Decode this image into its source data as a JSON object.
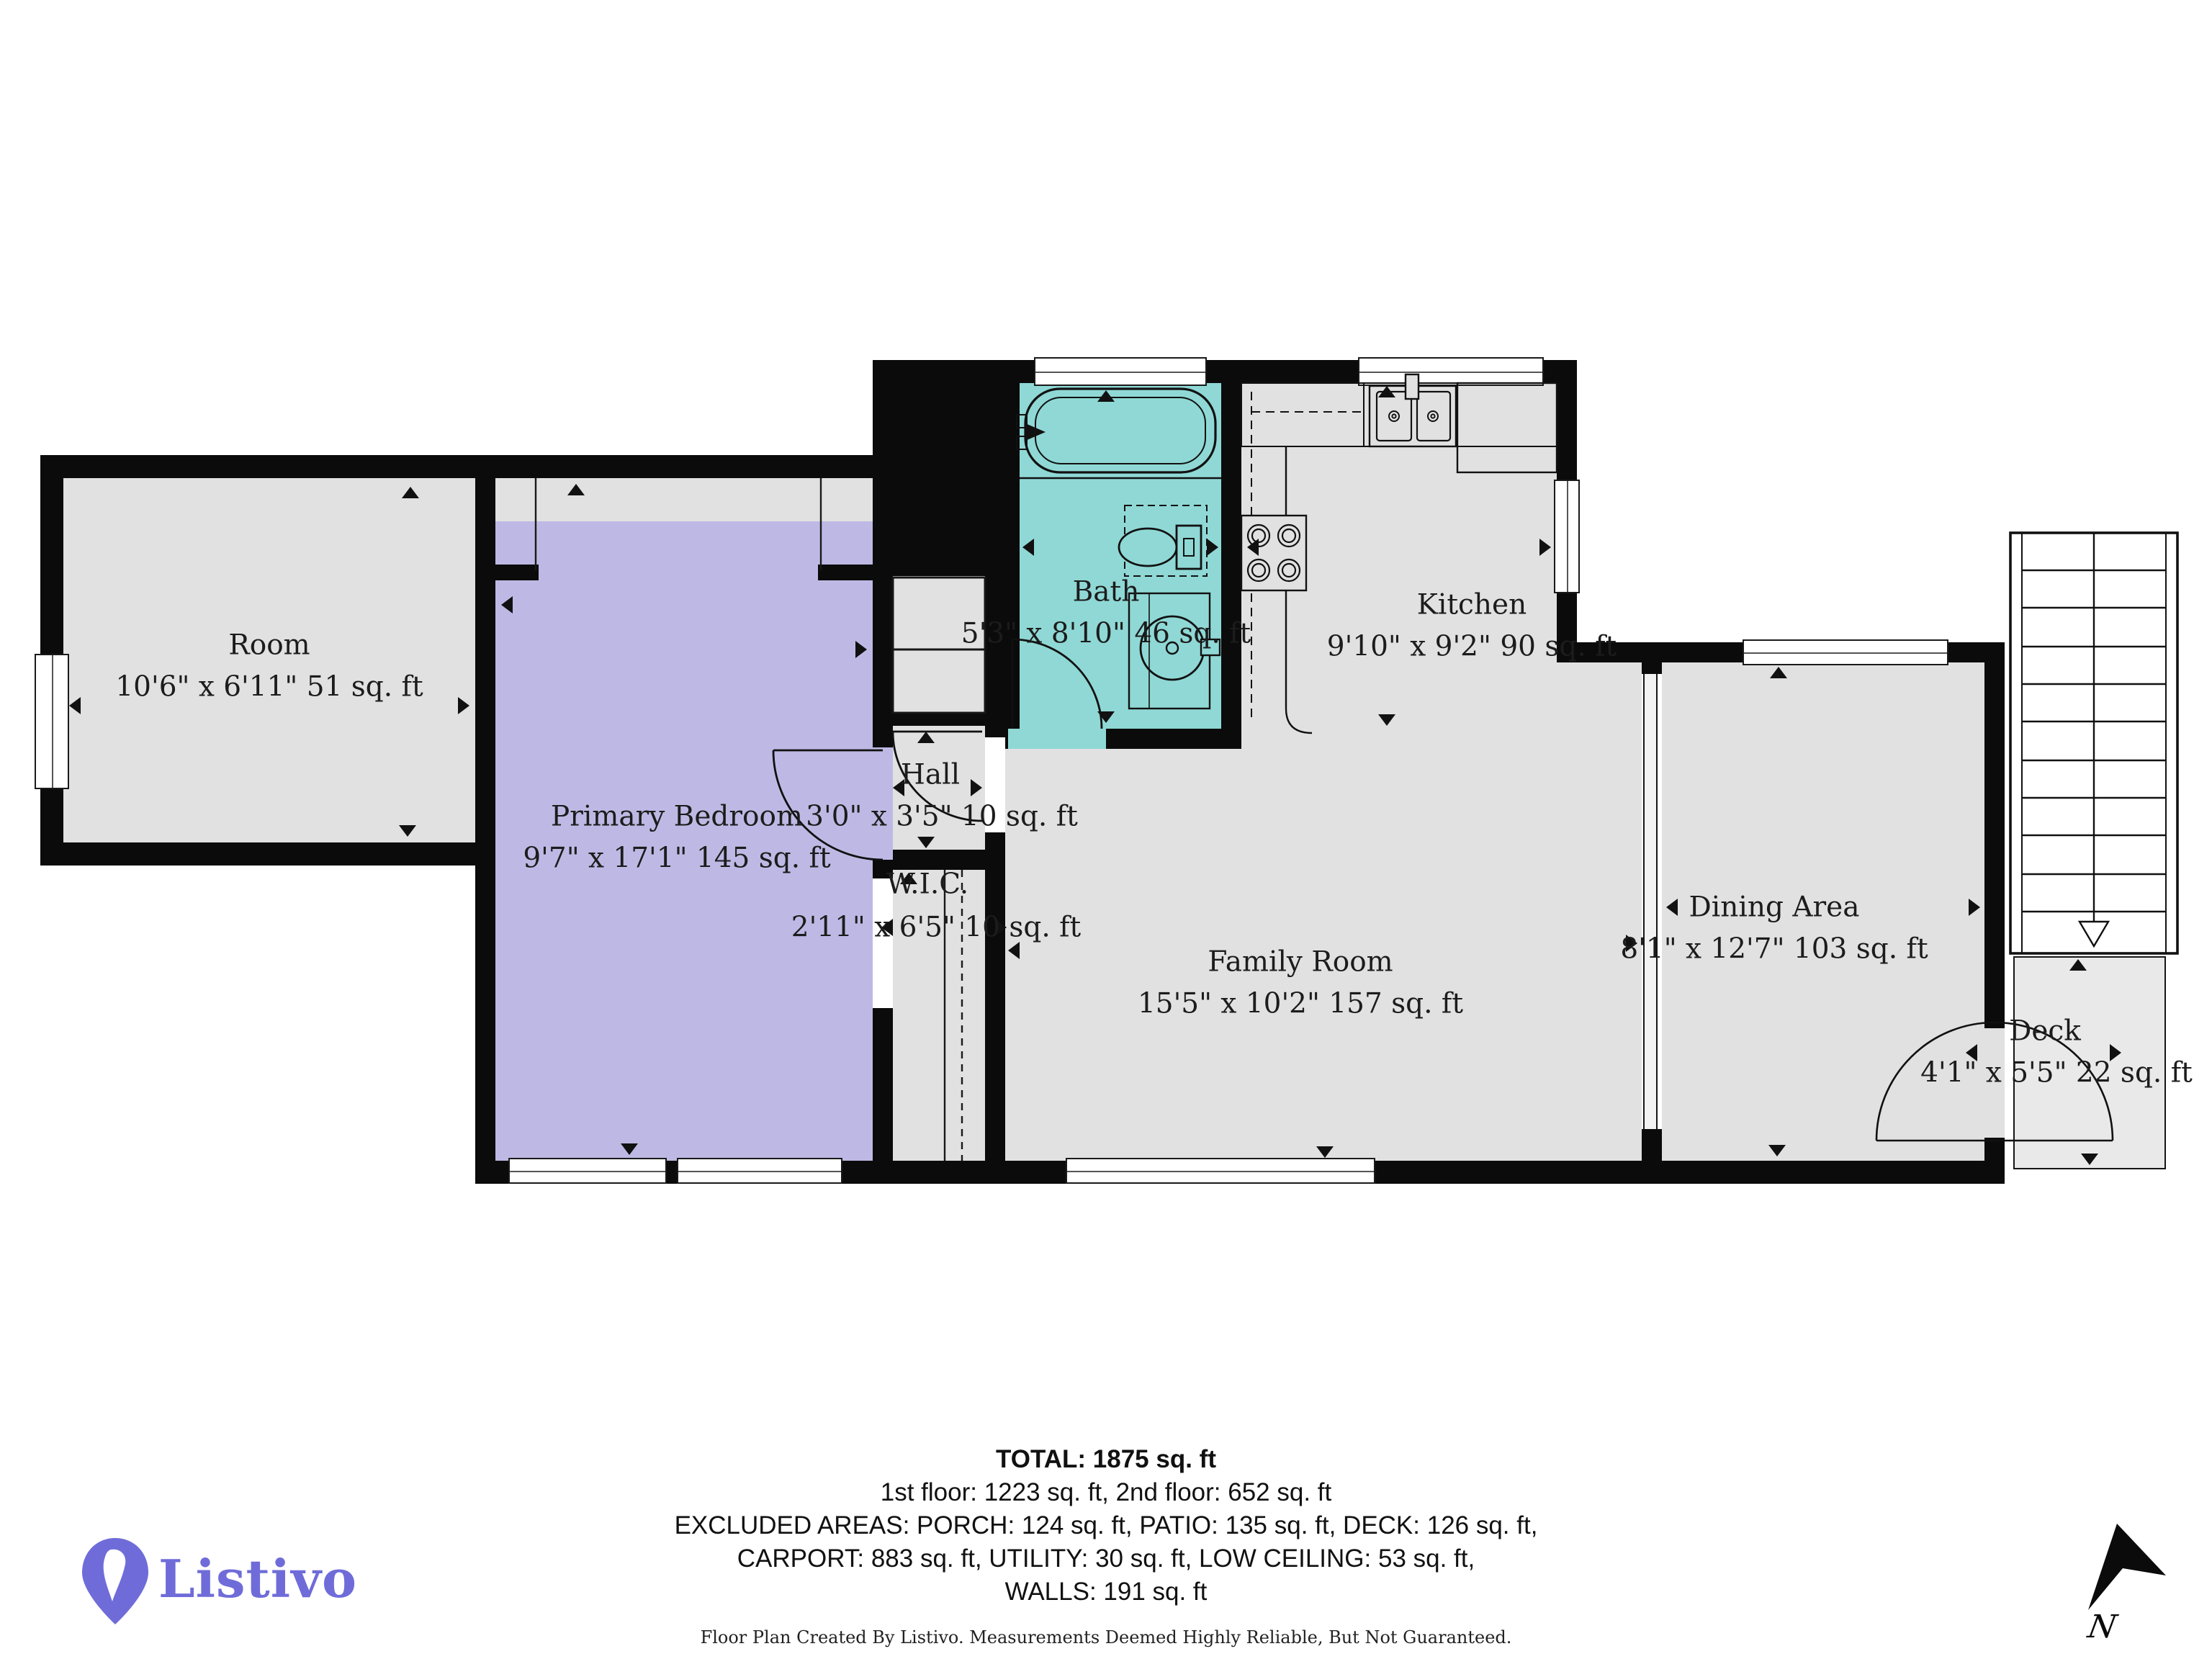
{
  "plan": {
    "rooms": [
      {
        "id": "room",
        "name": "Room",
        "dims": "10'6\" x 6'11\" 51 sq. ft"
      },
      {
        "id": "primary-bedroom",
        "name": "Primary Bedroom",
        "dims": "9'7\" x 17'1\" 145 sq. ft"
      },
      {
        "id": "bath",
        "name": "Bath",
        "dims": "5'3\" x 8'10\" 46 sq. ft"
      },
      {
        "id": "kitchen",
        "name": "Kitchen",
        "dims": "9'10\" x 9'2\" 90 sq. ft"
      },
      {
        "id": "hall",
        "name": "Hall",
        "dims": "3'0\" x 3'5\" 10 sq. ft"
      },
      {
        "id": "wic",
        "name": "W.I.C.",
        "dims": "2'11\" x 6'5\" 10 sq. ft"
      },
      {
        "id": "family-room",
        "name": "Family Room",
        "dims": "15'5\" x 10'2\" 157 sq. ft"
      },
      {
        "id": "dining-area",
        "name": "Dining Area",
        "dims": "8'1\" x 12'7\" 103 sq. ft"
      },
      {
        "id": "deck",
        "name": "Deck",
        "dims": "4'1\" x 5'5\" 22 sq. ft"
      }
    ],
    "colors": {
      "wall": "#0b0b0b",
      "floor": "#e1e1e1",
      "primary_bedroom_highlight": "#beb9e4",
      "bath_highlight": "#8fd8d5",
      "deck": "#e9e9e9"
    }
  },
  "summary": {
    "total": "TOTAL: 1875 sq. ft",
    "floors": "1st floor: 1223 sq. ft, 2nd floor: 652 sq. ft",
    "excluded1": "EXCLUDED AREAS: PORCH: 124 sq. ft, PATIO: 135 sq. ft, DECK: 126 sq. ft,",
    "excluded2": "CARPORT: 883 sq. ft, UTILITY: 30 sq. ft, LOW CEILING: 53 sq. ft,",
    "excluded3": "WALLS: 191 sq. ft"
  },
  "footer": {
    "disclaimer": "Floor Plan Created By Listivo. Measurements Deemed Highly Reliable, But Not Guaranteed."
  },
  "branding": {
    "logo_text": "Listivo",
    "logo_color": "#6f6cd9"
  },
  "compass": {
    "label": "N"
  }
}
